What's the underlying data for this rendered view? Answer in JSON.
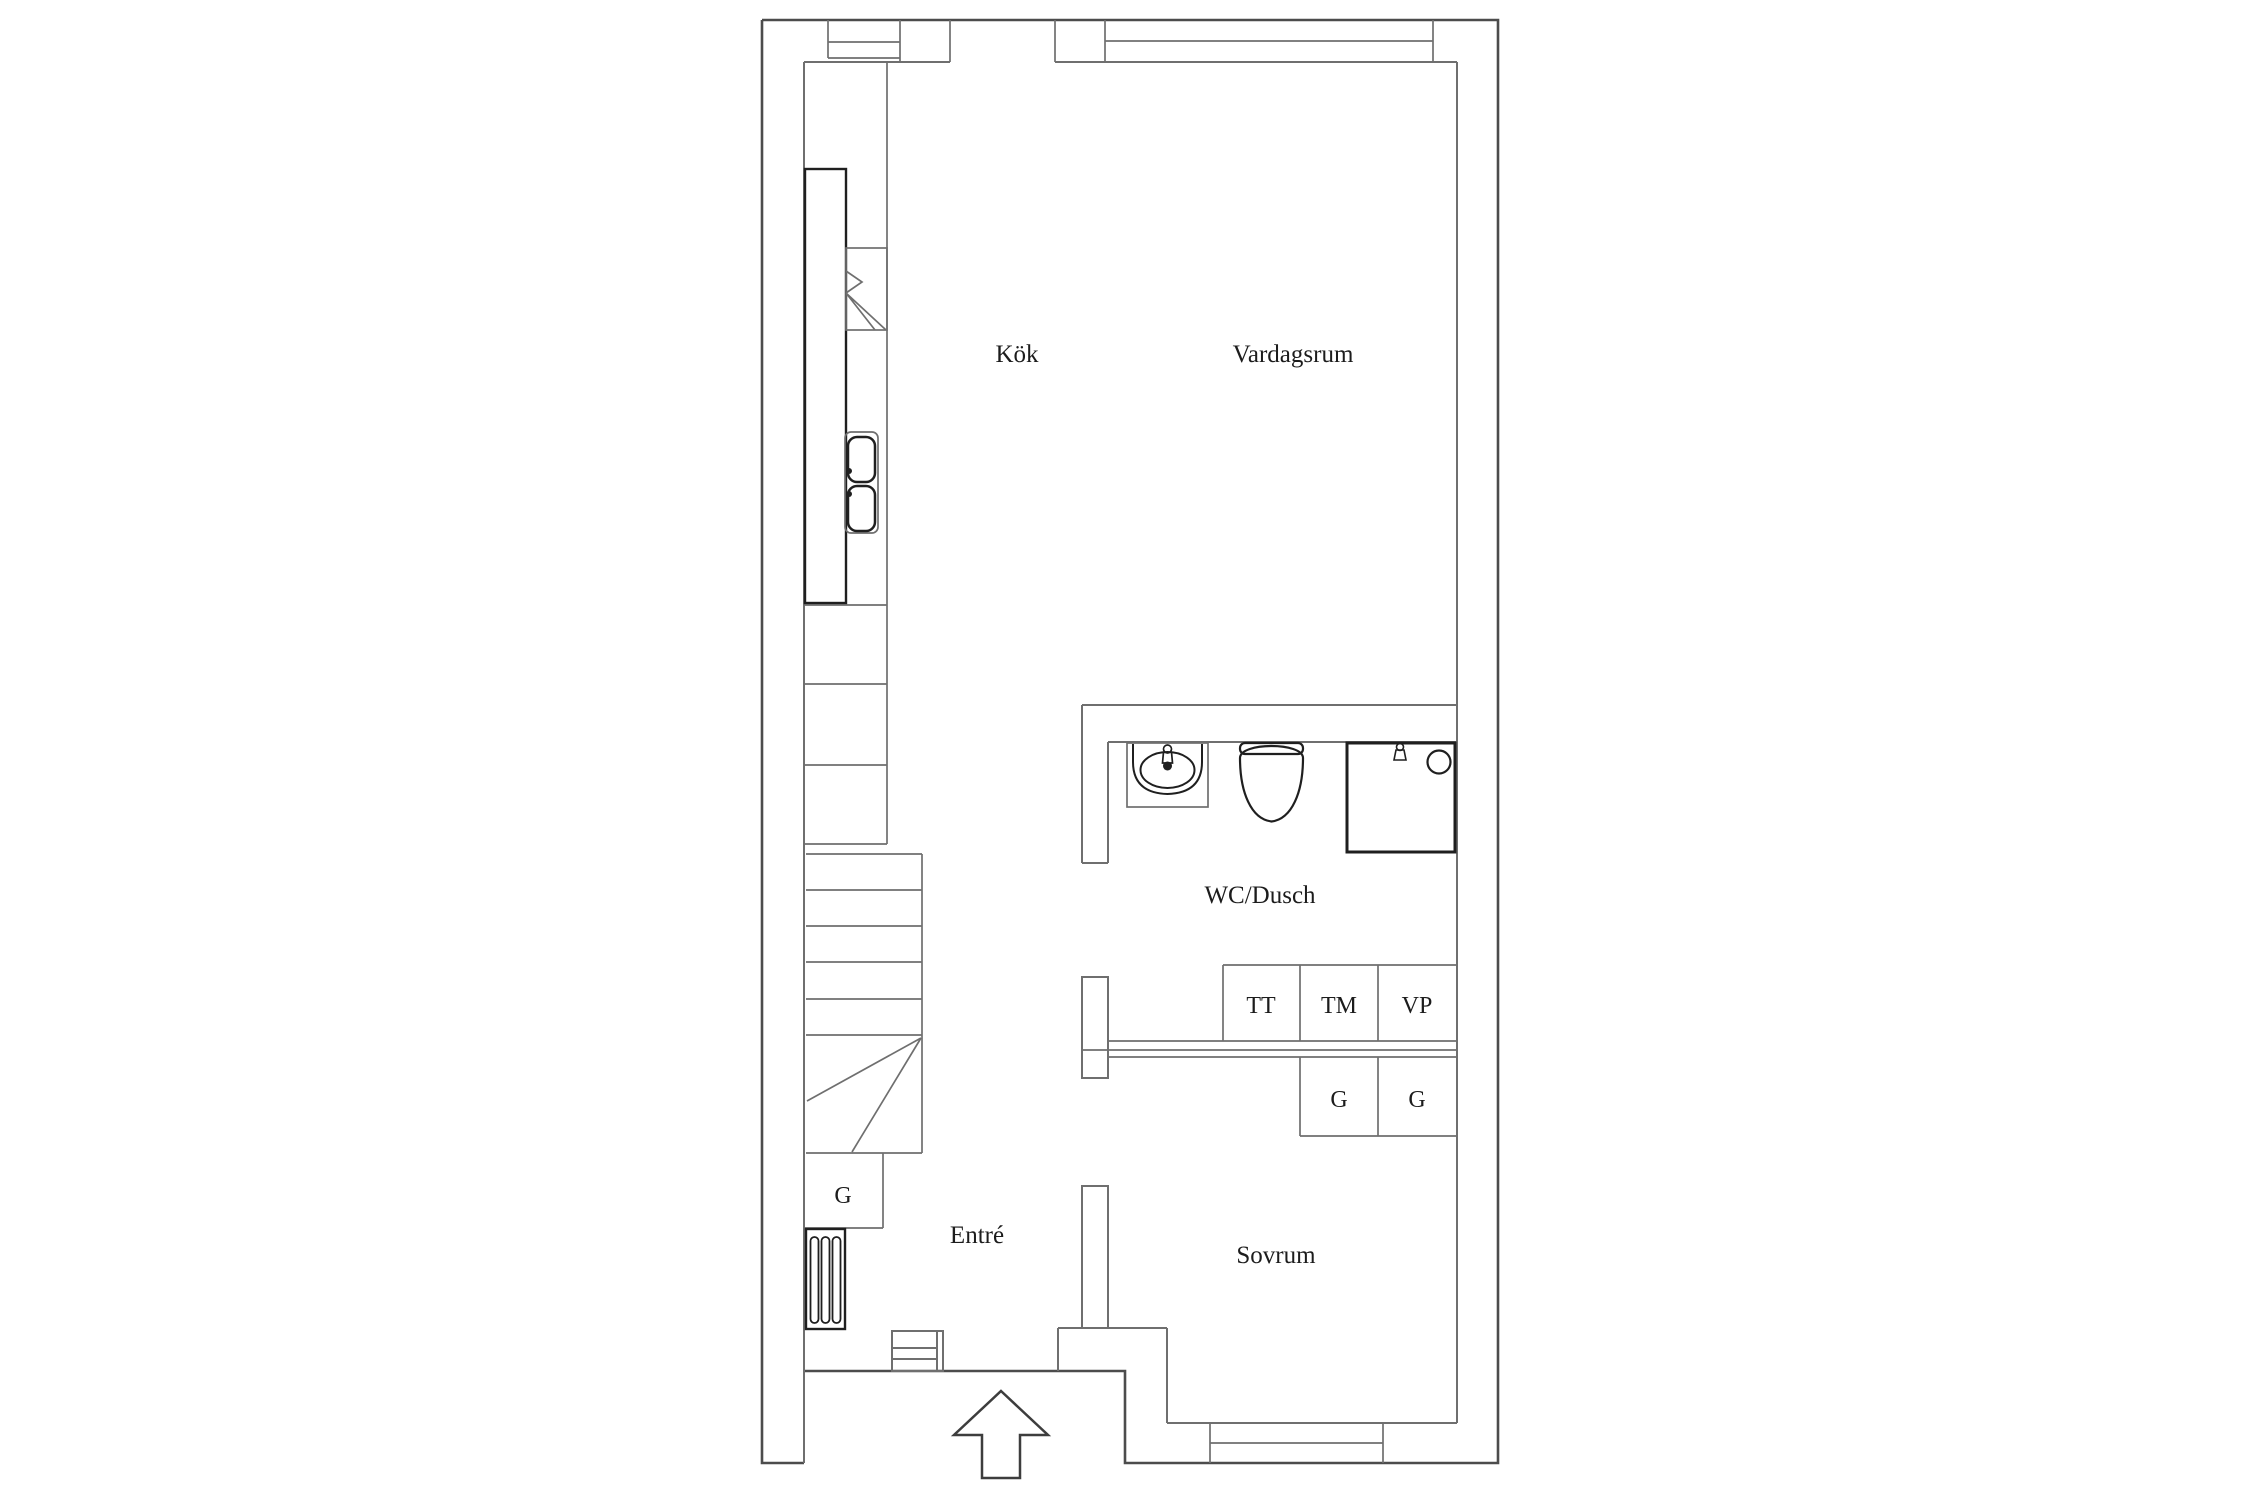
{
  "rooms": {
    "kitchen": {
      "label": "Kök"
    },
    "living_room": {
      "label": "Vardagsrum"
    },
    "bathroom": {
      "label": "WC/Dusch"
    },
    "entrance": {
      "label": "Entré"
    },
    "bedroom": {
      "label": "Sovrum"
    }
  },
  "fixtures": {
    "tumble_dryer": {
      "label": "TT"
    },
    "washing_machine": {
      "label": "TM"
    },
    "water_heater": {
      "label": "VP"
    },
    "bedroom_closet_left": {
      "label": "G"
    },
    "bedroom_closet_right": {
      "label": "G"
    },
    "entrance_closet": {
      "label": "G"
    }
  },
  "icons": {
    "entry_arrow": "entry-direction-arrow",
    "stairs": "staircase-with-winders",
    "kitchen_sink": "double-basin-sink",
    "kitchen_appliance": "stove-fan-symbol",
    "washbasin": "bathroom-washbasin",
    "toilet": "toilet",
    "shower": "shower-cabin",
    "radiator": "radiator-grille",
    "window": "double-line-window",
    "entry_door": "entrance-door-threshold"
  },
  "colors": {
    "outer-wall": "#4c4c4c",
    "wall": "#6f6f6f",
    "fixture": "#1f1f1f",
    "arrow": "#3d3d3d",
    "text": "#1c1c1c",
    "background": "#ffffff"
  }
}
